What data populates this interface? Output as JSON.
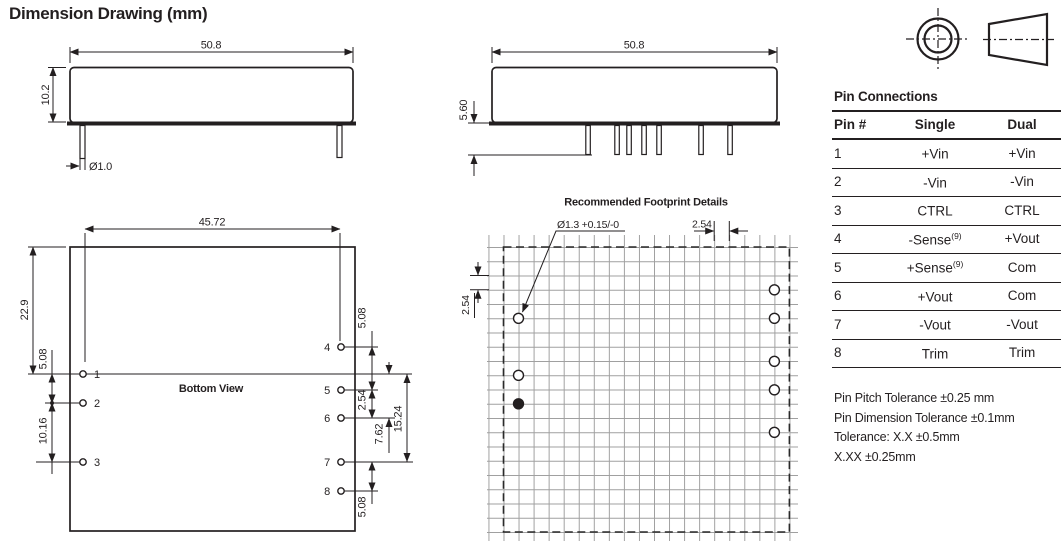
{
  "title": "Dimension Drawing (mm)",
  "colors": {
    "line": "#231f20",
    "grid": "#9f9f9f",
    "background": "#ffffff"
  },
  "views": {
    "side": {
      "width": "50.8",
      "height": "10.2",
      "pin_diameter": "Ø1.0"
    },
    "front": {
      "width": "50.8",
      "pin_length": "5.60"
    },
    "bottom": {
      "label": "Bottom View",
      "pin_span": "45.72",
      "top_to_pin1": "22.9",
      "pin1_pin2": "5.08",
      "pin2_pin3": "10.16",
      "pin4_pin5": "5.08",
      "pin5_pin6": "2.54",
      "pin_line_to_pin6": "7.62",
      "pin_line_to_pin7": "15.24",
      "pin7_pin8": "5.08",
      "left_pins": [
        "1",
        "2",
        "3"
      ],
      "right_pins": [
        "4",
        "5",
        "6",
        "7",
        "8"
      ]
    },
    "footprint": {
      "title": "Recommended Footprint Details",
      "hole_diameter": "Ø1.3 +0.15/-0",
      "grid_pitch_h": "2.54",
      "grid_pitch_v": "2.54"
    }
  },
  "pin_table": {
    "title": "Pin Connections",
    "headers": [
      "Pin #",
      "Single",
      "Dual"
    ],
    "rows": [
      {
        "pin": "1",
        "single": "+Vin",
        "single_sup": "",
        "dual": "+Vin"
      },
      {
        "pin": "2",
        "single": "-Vin",
        "single_sup": "",
        "dual": "-Vin"
      },
      {
        "pin": "3",
        "single": "CTRL",
        "single_sup": "",
        "dual": "CTRL"
      },
      {
        "pin": "4",
        "single": "-Sense",
        "single_sup": "(9)",
        "dual": "+Vout"
      },
      {
        "pin": "5",
        "single": "+Sense",
        "single_sup": "(9)",
        "dual": "Com"
      },
      {
        "pin": "6",
        "single": "+Vout",
        "single_sup": "",
        "dual": "Com"
      },
      {
        "pin": "7",
        "single": "-Vout",
        "single_sup": "",
        "dual": "-Vout"
      },
      {
        "pin": "8",
        "single": "Trim",
        "single_sup": "",
        "dual": "Trim"
      }
    ],
    "notes": [
      "Pin Pitch Tolerance ±0.25 mm",
      "Pin Dimension Tolerance ±0.1mm",
      "Tolerance: X.X ±0.5mm",
      "X.XX ±0.25mm"
    ]
  }
}
